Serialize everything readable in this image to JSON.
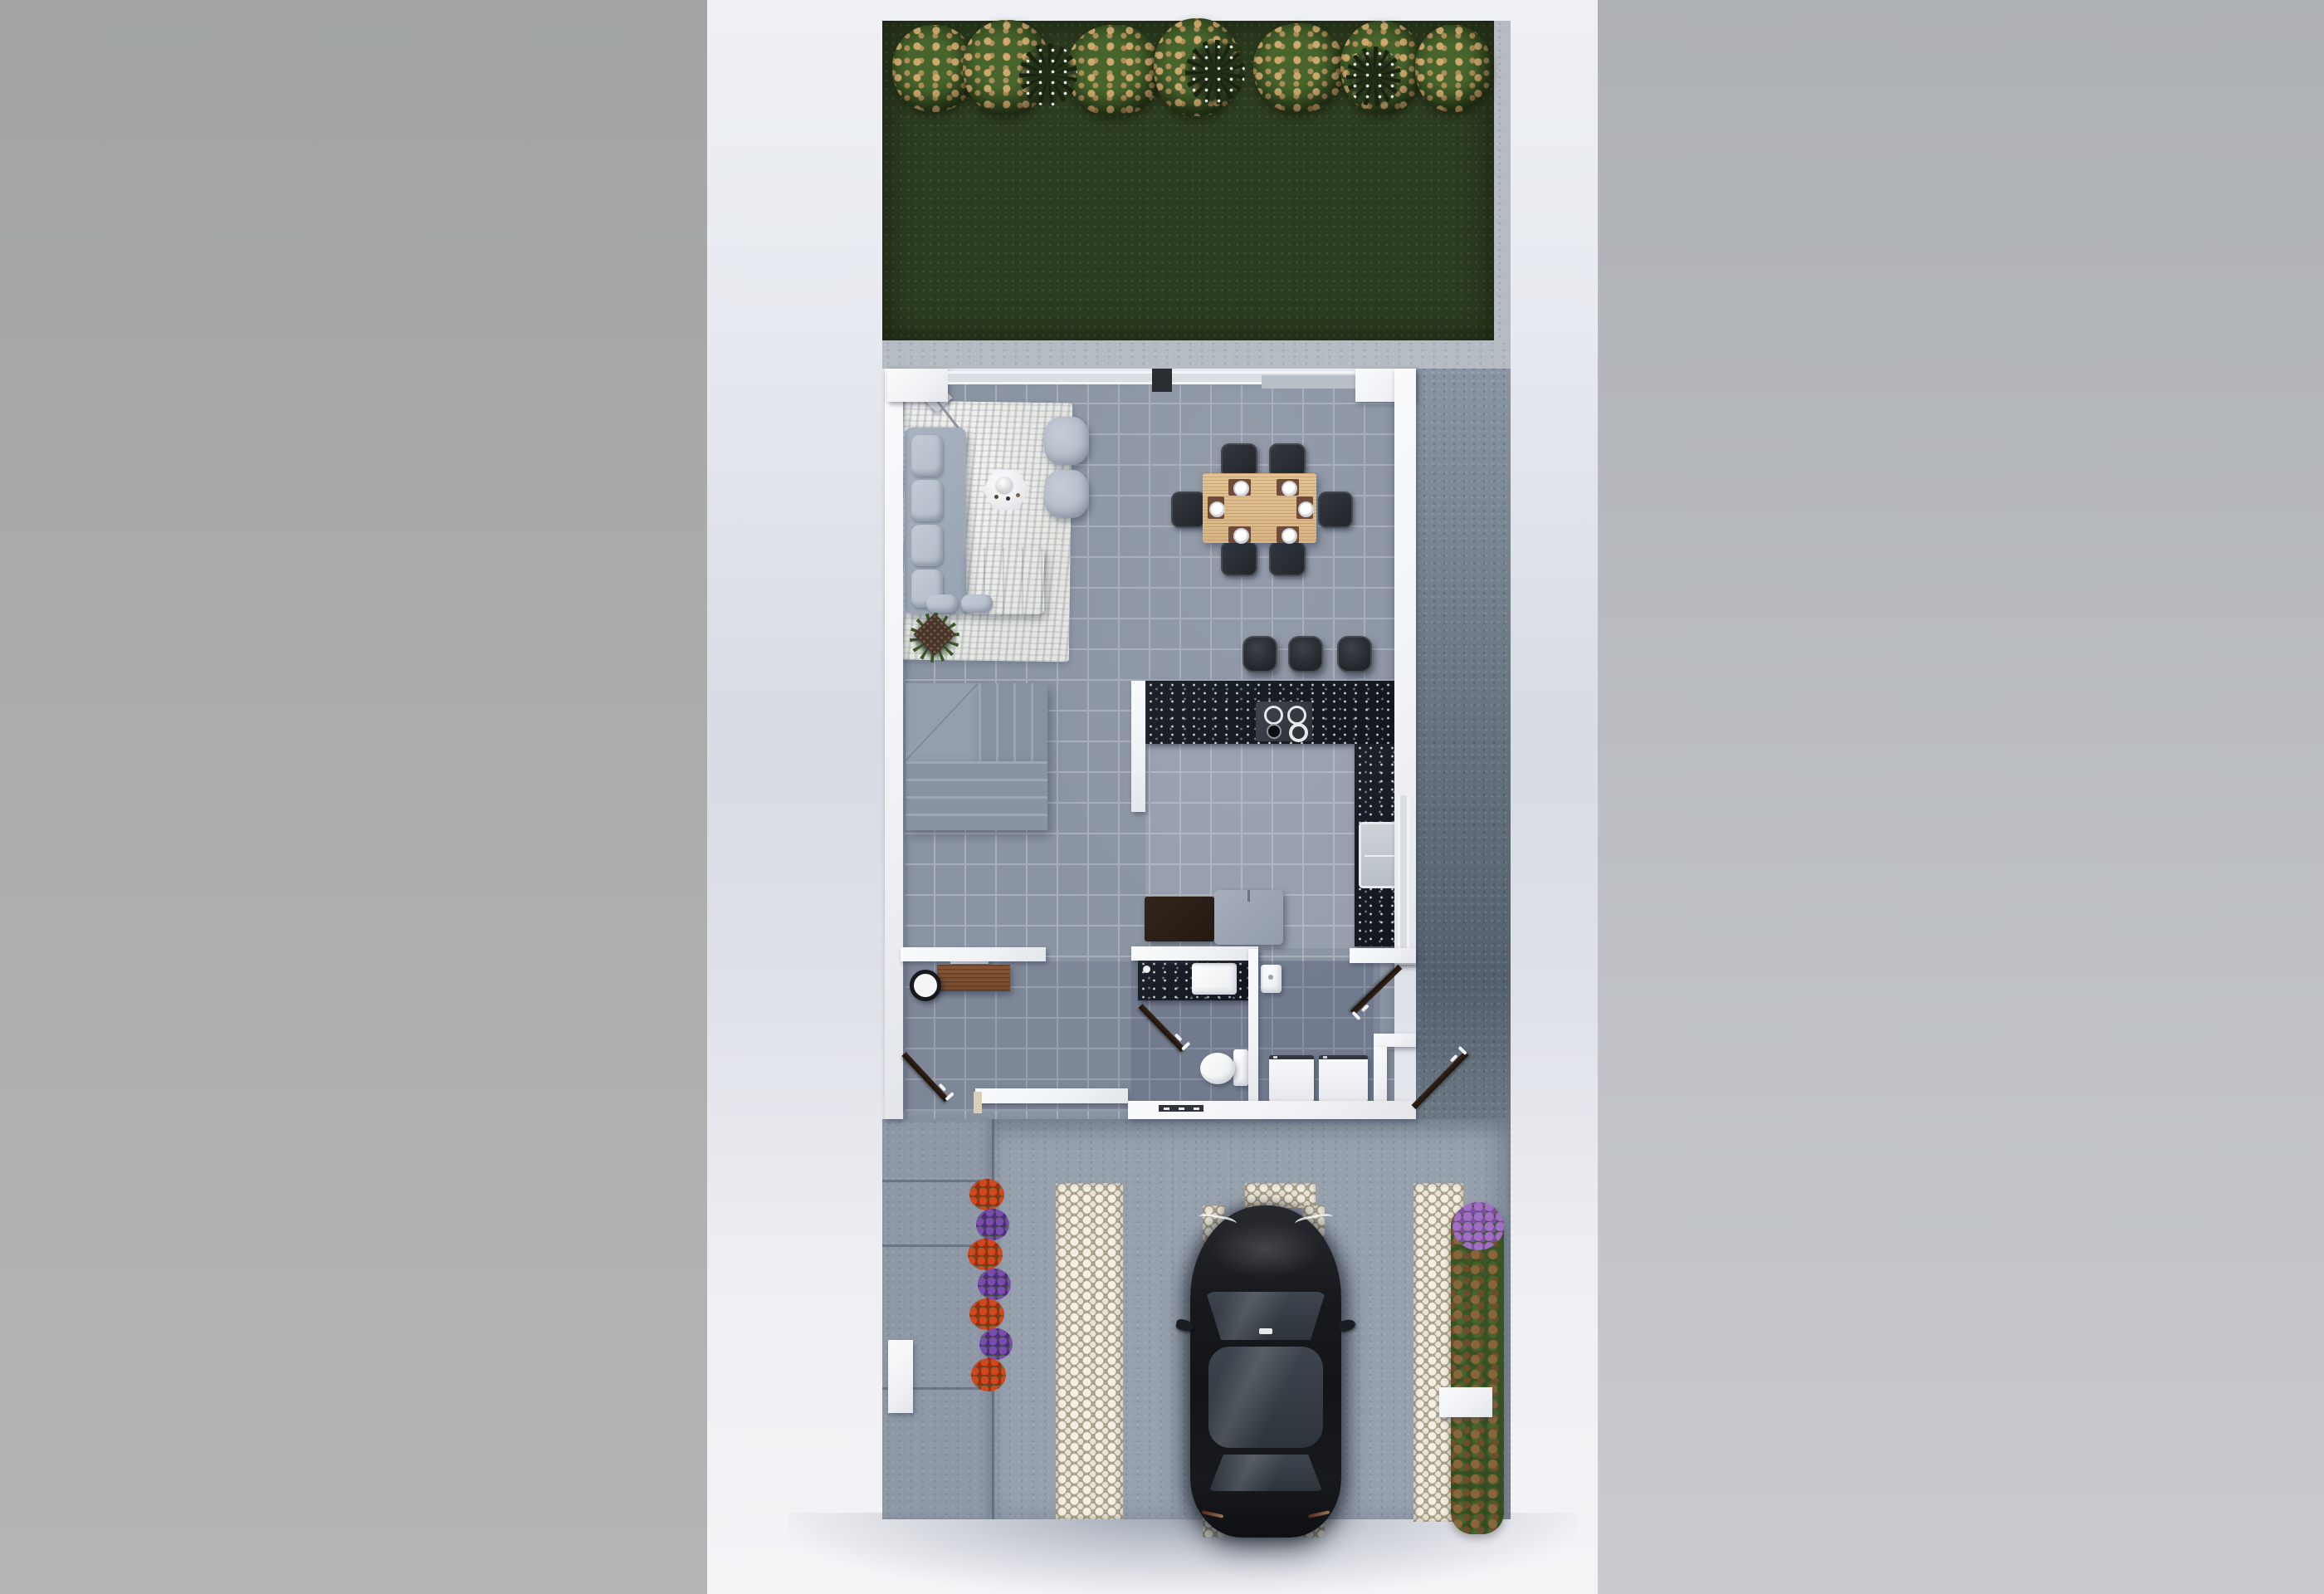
{
  "title": "Top-down 3D render of a two-storey house lot: back lawn with hedge, open-plan ground floor and front driveway with parked car",
  "colors": {
    "bg_left": "#a2a5a2",
    "bg_right": "#adb0b5",
    "page": "#edeff3",
    "grass": "#2c3c1e",
    "bush_green": "#46642c",
    "flower_tan": "#c89a5f",
    "spiky": "#18240f",
    "patio": "#b5bbc2",
    "tile": "#8b94a3",
    "grout": "#a8afba",
    "wall": "#eff1f4",
    "glass": "#d9dee5",
    "granite": "#12161d",
    "wood_table": "#d7b584",
    "wood_desk": "#754a2e",
    "cabinet": "#241a12",
    "fridge": "#939caa",
    "sofa": "#98a3b2",
    "cushion": "#b3bbc8",
    "rug": "#e7e7e1",
    "seat_dark": "#22252a",
    "placemat": "#6f4b38",
    "sideyard": "#67727f",
    "walkway": "#8e98a6",
    "concrete": "#97a1ae",
    "pebble_base": "#b7ae99",
    "pebble_stone": "#f3efe3",
    "flower_red": "#d1481f",
    "flower_purple": "#7a4cb0",
    "leaf": "#3c5a28",
    "plant_brown": "#8a653c",
    "plant_purple": "#a06fc4",
    "car_body": "#17191d",
    "car_glass": "#343b44",
    "white_block": "#eef0f2"
  },
  "scene": {
    "backyard": {
      "areas": [
        "lawn",
        "hedge-row",
        "patio-strip"
      ],
      "hedge": {
        "flowering_bushes": 7,
        "spiky_plants": 3
      }
    },
    "house": {
      "rooms": [
        "living-room",
        "dining-area",
        "kitchen",
        "entry-hall",
        "bathroom",
        "laundry",
        "staircase"
      ],
      "living_room": [
        "area-rug",
        "sectional-sofa",
        "ottoman",
        "ottoman",
        "coffee-table",
        "floor-decor",
        "potted-plant"
      ],
      "dining_area": {
        "table": "wood-dining-table",
        "chairs": 6,
        "place_settings": 6
      },
      "kitchen": [
        "granite-counter",
        "cooktop",
        "double-sink",
        "refrigerator",
        "cabinet",
        "bar-stools-x3"
      ],
      "bathroom": [
        "vanity",
        "sink",
        "toilet",
        "shower-basin"
      ],
      "laundry": [
        "washer",
        "dryer"
      ],
      "open_doors": 4
    },
    "frontyard": {
      "areas": [
        "walkway",
        "driveway",
        "pebble-strips",
        "flower-bed",
        "planting-strip"
      ],
      "vehicle": {
        "type": "sedan",
        "color_name": "black",
        "heading": "nose-up"
      },
      "objects": [
        "gate-post",
        "utility-pad"
      ]
    }
  }
}
